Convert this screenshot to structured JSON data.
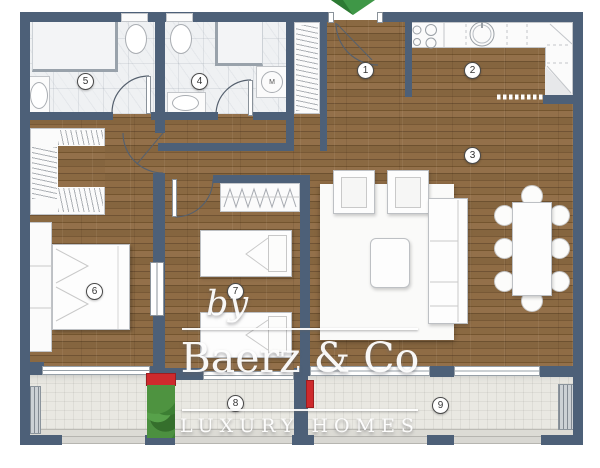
{
  "plan": {
    "description": "apartment floor plan",
    "rooms": {
      "entrance": {
        "number": "1"
      },
      "kitchen": {
        "number": "2"
      },
      "living_room": {
        "number": "3"
      },
      "bathroom_2": {
        "number": "4"
      },
      "bathroom_1": {
        "number": "5"
      },
      "bedroom_1": {
        "number": "6"
      },
      "bedroom_2": {
        "number": "7"
      },
      "balcony_1": {
        "number": "8"
      },
      "balcony_2": {
        "number": "9"
      }
    },
    "fixtures": {
      "washing_machine_label": "M"
    }
  },
  "watermark": {
    "prefix": "by",
    "brand": "Baerz & Co",
    "tagline": "LUXURY HOMES"
  },
  "colors": {
    "wall": "#4d6078",
    "wood": "#83633d",
    "marble_tile": "#eff1f3",
    "balcony_tile": "#e9e8e2",
    "accent_red": "#ce2a2d",
    "arrow_green": "#3f9747",
    "watermark_white": "#ffffff"
  }
}
